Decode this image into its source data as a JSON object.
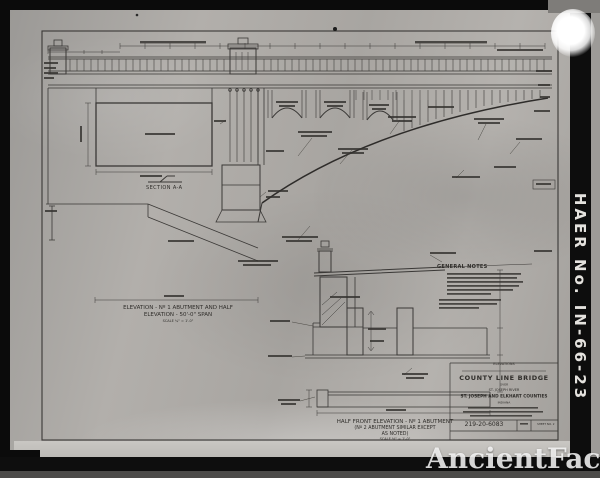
{
  "photo": {
    "haer_number": "HAER No. IN-66-23",
    "watermark": "AncientFaces"
  },
  "drawing": {
    "section_aa_label": "SECTION A-A",
    "elevation_caption_line1": "ELEVATION - Nº 1 ABUTMENT AND HALF",
    "elevation_caption_line2": "ELEVATION - 50'-0\" SPAN",
    "elevation_caption_line3": "SCALE ¼\" = 1'-0\"",
    "half_front_caption_line1": "HALF FRONT ELEVATION - Nº 1 ABUTMENT",
    "half_front_caption_line2": "(Nº 2 ABUTMENT SIMILAR EXCEPT",
    "half_front_caption_line3": "AS NOTED)",
    "half_front_caption_line4": "SCALE ½\" = 1'-0\"",
    "general_notes_heading": "GENERAL NOTES",
    "title_block": {
      "discipline": "ELEVATIONS",
      "bridge_name": "COUNTY LINE BRIDGE",
      "over_label": "OVER",
      "river": "ST. JOSEPH RIVER",
      "counties": "ST. JOSEPH AND ELKHART COUNTIES",
      "state": "INDIANA",
      "drawing_number": "219-20-6083",
      "sheet_label": "SHEET NO. 2"
    }
  }
}
